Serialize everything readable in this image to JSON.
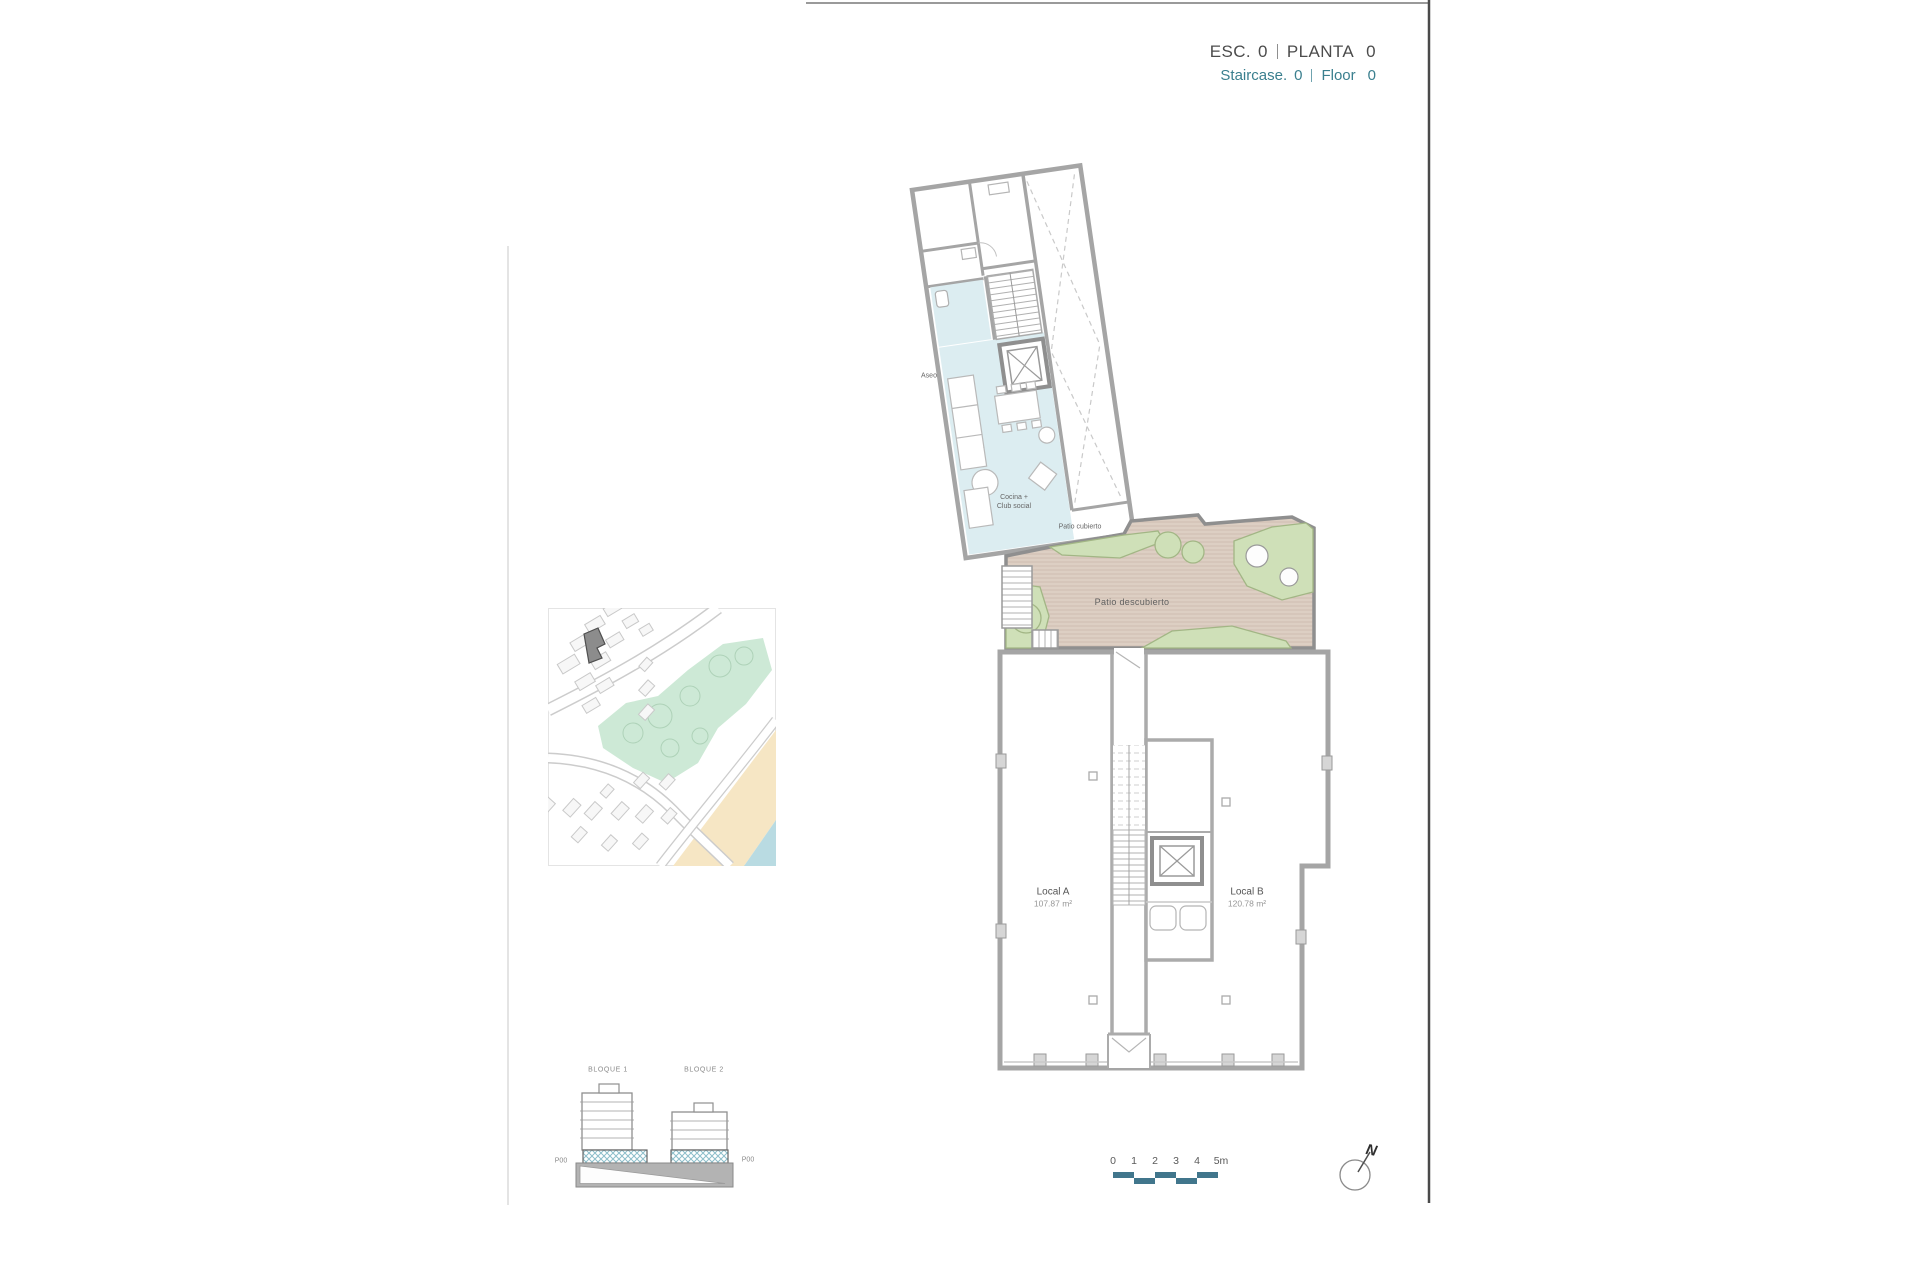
{
  "header": {
    "esc_label": "ESC.",
    "esc_value": "0",
    "planta_label": "PLANTA",
    "planta_value": "0",
    "staircase_label": "Staircase.",
    "staircase_value": "0",
    "floor_label": "Floor",
    "floor_value": "0"
  },
  "plan": {
    "labels": {
      "aseo": "Aseo",
      "cocina_line1": "Cocina +",
      "cocina_line2": "Club social",
      "patio_cubierto": "Patio cubierto",
      "patio_descubierto": "Patio descubierto",
      "local_a_name": "Local A",
      "local_a_area": "107.87 m²",
      "local_b_name": "Local B",
      "local_b_area": "120.78 m²"
    }
  },
  "elevation": {
    "bloque1": "BLOQUE 1",
    "bloque2": "BLOQUE 2",
    "p00_left": "P00",
    "p00_right": "P00"
  },
  "scale_bar": {
    "ticks": [
      "0",
      "1",
      "2",
      "3",
      "4",
      "5m"
    ]
  },
  "north": {
    "label": "N"
  },
  "colors": {
    "accent_teal": "#41768c",
    "header_teal": "#3a7f8e",
    "wall_gray": "#a5a5a5",
    "room_blue": "#dcedf1",
    "patio_tan": "#ddcfc3",
    "plant_green": "#cfe0b8",
    "map_park": "#cde9d6",
    "map_sand": "#f6e6c4",
    "map_sea": "#b9dbe2",
    "subject_building": "#8c8c8c"
  }
}
